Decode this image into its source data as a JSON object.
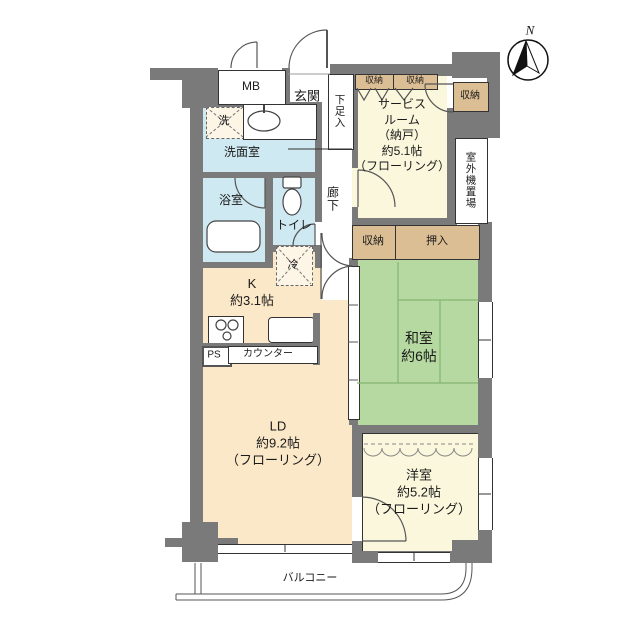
{
  "compass": {
    "north_label": "N"
  },
  "rooms": {
    "mb": "MB",
    "entrance": "玄関",
    "shoe_box": "下足入",
    "service_room": {
      "line1": "サービス",
      "line2": "ルーム",
      "line3": "（納戸）",
      "line4": "約5.1帖",
      "line5": "（フローリング）"
    },
    "storage_top_left": "収納",
    "storage_top_right": "収納",
    "storage_upper_right": "収納",
    "outdoor_unit_space": "室外機置場",
    "washer": "洗",
    "washroom": "洗面室",
    "bathroom": "浴室",
    "toilet": "トイレ",
    "corridor": "廊下",
    "storage_mid": "収納",
    "oshiire": "押入",
    "fridge": "冷",
    "kitchen": {
      "line1": "K",
      "line2": "約3.1帖"
    },
    "ps": "PS",
    "counter": "カウンター",
    "japanese_room": {
      "line1": "和室",
      "line2": "約6帖"
    },
    "living_dining": {
      "line1": "LD",
      "line2": "約9.2帖",
      "line3": "（フローリング）"
    },
    "western_room": {
      "line1": "洋室",
      "line2": "約5.2帖",
      "line3": "（フローリング）"
    },
    "balcony": "バルコニー"
  },
  "colors": {
    "wall": "#7a7a7a",
    "ld_kitchen_fill": "#fbe8c8",
    "tatami_fill": "#b5d9a0",
    "western_fill": "#fbf7dc",
    "wet_area_fill": "#cfe9f2",
    "storage_fill": "#dcbe94",
    "line": "#333333"
  }
}
